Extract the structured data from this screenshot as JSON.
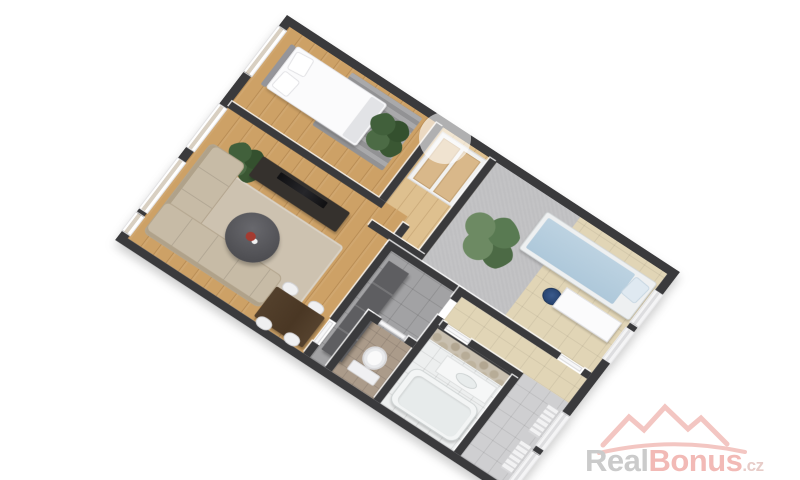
{
  "page": {
    "background": "#ffffff"
  },
  "watermark": {
    "logo_icon": "house-roofs-icon",
    "swoosh_icon": "swoosh-underline-icon",
    "text_real": "Real",
    "text_bonus": "Bonus",
    "text_tld": ".cz",
    "colors": {
      "real": "#c7c7c7",
      "bonus": "#f1b5b0",
      "tld": "#e6c8c4",
      "roofs": "#f3c2bd"
    }
  },
  "scene": {
    "type": "3d-floorplan-render",
    "rotation_deg": 33.5,
    "wall_color": "#3a3a3c",
    "rooms": [
      {
        "name": "bedroom",
        "floor": "wood",
        "furniture": [
          "double-bed",
          "striped-rug",
          "plant",
          "window"
        ]
      },
      {
        "name": "closet-nook",
        "floor": "wood-light",
        "furniture": [
          "wardrobe"
        ]
      },
      {
        "name": "kids-room",
        "floor": "beige-tile-and-gray-carpet",
        "furniture": [
          "single-bed",
          "desk",
          "office-chair",
          "palm-plant"
        ]
      },
      {
        "name": "living-room",
        "floor": "wood",
        "furniture": [
          "corner-sofa",
          "coffee-table",
          "tv-sideboard",
          "dining-table",
          "chairs",
          "rug",
          "plant",
          "windows"
        ]
      },
      {
        "name": "hallway",
        "floor": "gray-tile",
        "furniture": [
          "wardrobe-cabinet"
        ]
      },
      {
        "name": "bathroom",
        "floor": "white-tile",
        "furniture": [
          "bathtub",
          "vanity-sink",
          "stone-wall"
        ]
      },
      {
        "name": "wc",
        "floor": "brown-tile",
        "furniture": [
          "toilet"
        ]
      },
      {
        "name": "entry-corridor",
        "floor": "gray-tile",
        "furniture": [
          "radiator",
          "doors"
        ]
      }
    ]
  }
}
